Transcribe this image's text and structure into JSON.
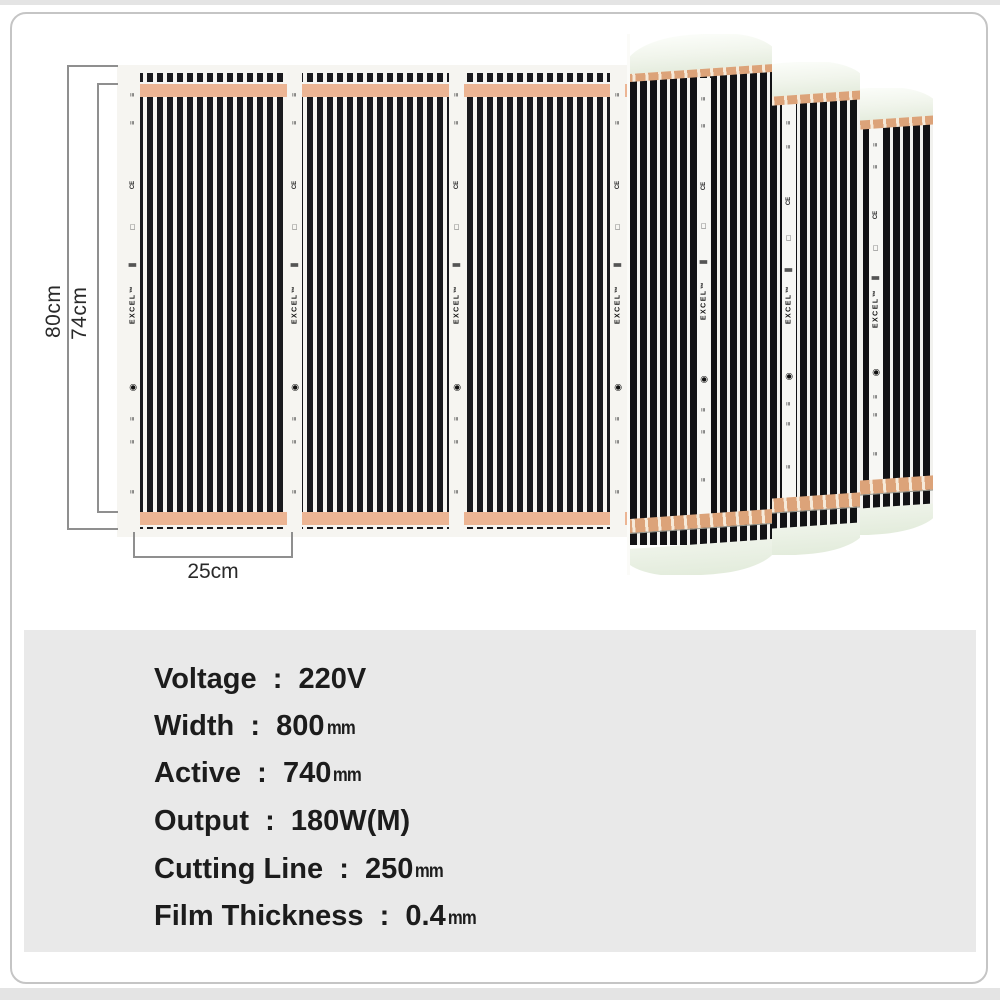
{
  "product": {
    "type": "infrared-heating-film-product-diagram",
    "film": {
      "brand": "EXCEL™",
      "brand_marks": [
        {
          "glyph": "≡",
          "top": 4,
          "kind": "ticks"
        },
        {
          "glyph": "≡",
          "top": 10,
          "kind": "ticks"
        },
        {
          "glyph": "CE",
          "top": 24,
          "kind": "text"
        },
        {
          "glyph": "□",
          "top": 33,
          "kind": "square"
        },
        {
          "glyph": "▮",
          "top": 41,
          "kind": "bar"
        },
        {
          "glyph": "EXCEL™",
          "top": 50,
          "kind": "brand"
        },
        {
          "glyph": "◉",
          "top": 68,
          "kind": "logo"
        },
        {
          "glyph": "≡",
          "top": 75,
          "kind": "ticks"
        },
        {
          "glyph": "≡",
          "top": 80,
          "kind": "ticks"
        },
        {
          "glyph": "≡",
          "top": 91,
          "kind": "ticks"
        }
      ],
      "segments_visible": 4,
      "rolls_visible": 3
    },
    "dimensions": {
      "overall_width_label": "80cm",
      "active_width_label": "74cm",
      "cutting_segment_label": "25cm"
    },
    "colors": {
      "copper_busbar": "#ecb594",
      "roll_copper": "#dca379",
      "stripe_black": "#1a1a1e",
      "film_background": "#f6f5f1",
      "frame_border": "#c5c5c5",
      "spec_box_background": "#e9e9e9",
      "dimension_line": "#8f8f8f"
    }
  },
  "specs": {
    "separator": "  :  ",
    "rows": [
      {
        "label": "Voltage",
        "value": "220V",
        "unit": ""
      },
      {
        "label": "Width",
        "value": "800",
        "unit": "mm"
      },
      {
        "label": "Active",
        "value": "740",
        "unit": "mm"
      },
      {
        "label": "Output",
        "value": "180W(M)",
        "unit": ""
      },
      {
        "label": "Cutting Line",
        "value": "250",
        "unit": "mm"
      },
      {
        "label": "Film Thickness",
        "value": "0.4",
        "unit": "mm"
      }
    ]
  }
}
